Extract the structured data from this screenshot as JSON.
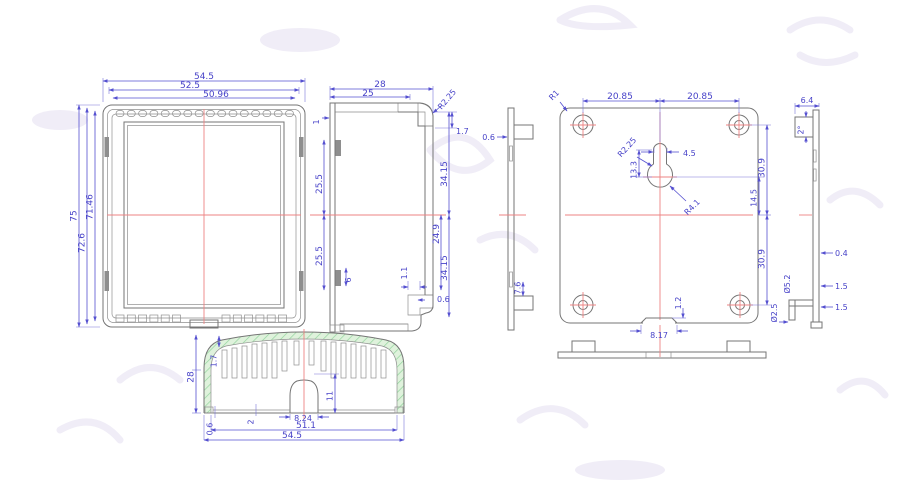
{
  "drawing": {
    "kind": "enclosure-technical-drawing",
    "colors": {
      "dimension_blue": "#4742c8",
      "outline_gray": "#757575",
      "centerline_red": "#ee8383",
      "hatch_green_fill": "#dff2dc",
      "hatch_green_line": "#93d49e",
      "background": "#ffffff"
    },
    "views": {
      "front": {
        "top_dims": [
          "54.5",
          "52.5",
          "50.96"
        ],
        "left_dims": [
          "75",
          "72.6",
          "71.46"
        ]
      },
      "side": {
        "top_dims": [
          "28",
          "25"
        ],
        "radius": "R2.25",
        "right_dims": [
          "1.7",
          "34.15",
          "24.9",
          "34.15",
          "1.1",
          "0.6"
        ],
        "left_dims": [
          "1",
          "25.5",
          "25.5",
          "6"
        ]
      },
      "bottom": {
        "height": "28",
        "rib": "1.7",
        "arch_h": "11",
        "arch_w": "8.24",
        "wall": "2",
        "lip": "0.6",
        "inner_w": "51.1",
        "outer_w": "54.5"
      },
      "plate": {
        "corner_r": "R1",
        "hole_span": [
          "20.85",
          "20.85"
        ],
        "key_r_top": "R2.25",
        "key_w": "4.5",
        "key_h": "13.3",
        "key_r_bot": "R4.1",
        "right_dims": [
          "30.9",
          "14.5",
          "30.9"
        ],
        "notch_w": "8.17",
        "notch_h": "1.2",
        "edge_t": "0.6",
        "tab_h": "7.6"
      },
      "profile": {
        "tab_w": "6.4",
        "draft": "2°",
        "wall_t": "0.4",
        "t1": "1.5",
        "t2": "1.5",
        "d1": "Ø5.2",
        "d2": "Ø2.5"
      }
    }
  }
}
